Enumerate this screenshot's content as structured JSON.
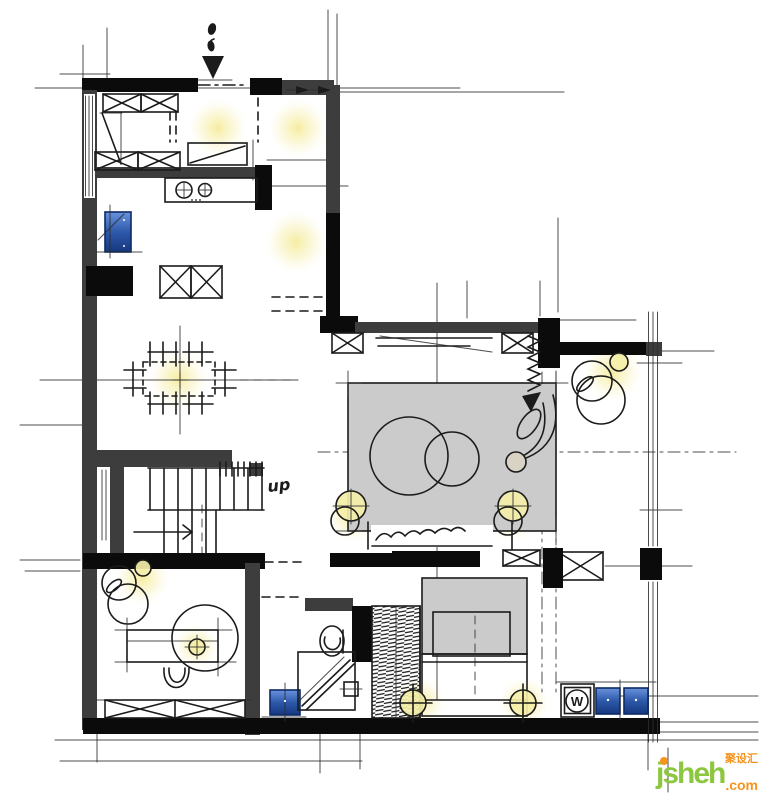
{
  "plan": {
    "labels": {
      "stairs_direction": "up",
      "washing_machine": "W"
    },
    "watermark": {
      "brand": "jsheh",
      "tld": ".com",
      "cn_text": "聚设汇"
    },
    "colors": {
      "paper": "#ffffff",
      "ink": "#1b1b1b",
      "wall": "#3d3d3d",
      "wall-black": "#0b0b0b",
      "furn-gray": "#cbcbcb",
      "lamp-yellow": "#f5efa9",
      "glow-yellow": "#f6eda0",
      "appliance-blue": "#2d59aa",
      "wm-green": "#8dc63f",
      "wm-orange": "#f7941d"
    }
  }
}
